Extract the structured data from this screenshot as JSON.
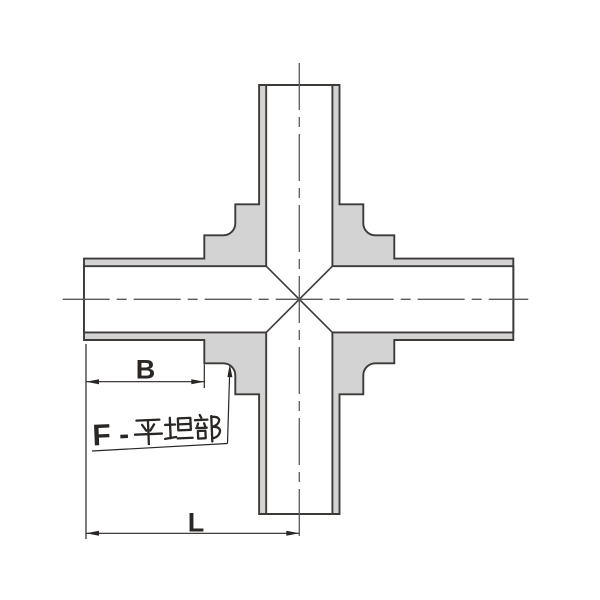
{
  "figure": {
    "type": "technical-drawing-cross-fitting-section-view",
    "labels": {
      "dim_b": "B",
      "dim_l": "L",
      "flat_note": "F - 平坦部",
      "flat_note_prefix": "F -",
      "flat_note_kanji": "平坦部"
    },
    "colors": {
      "body_fill": "#d3d3d3",
      "outline": "#3d3a38",
      "centerline": "#5a5a5a",
      "dimension": "#2a2624",
      "background": "#ffffff"
    }
  }
}
